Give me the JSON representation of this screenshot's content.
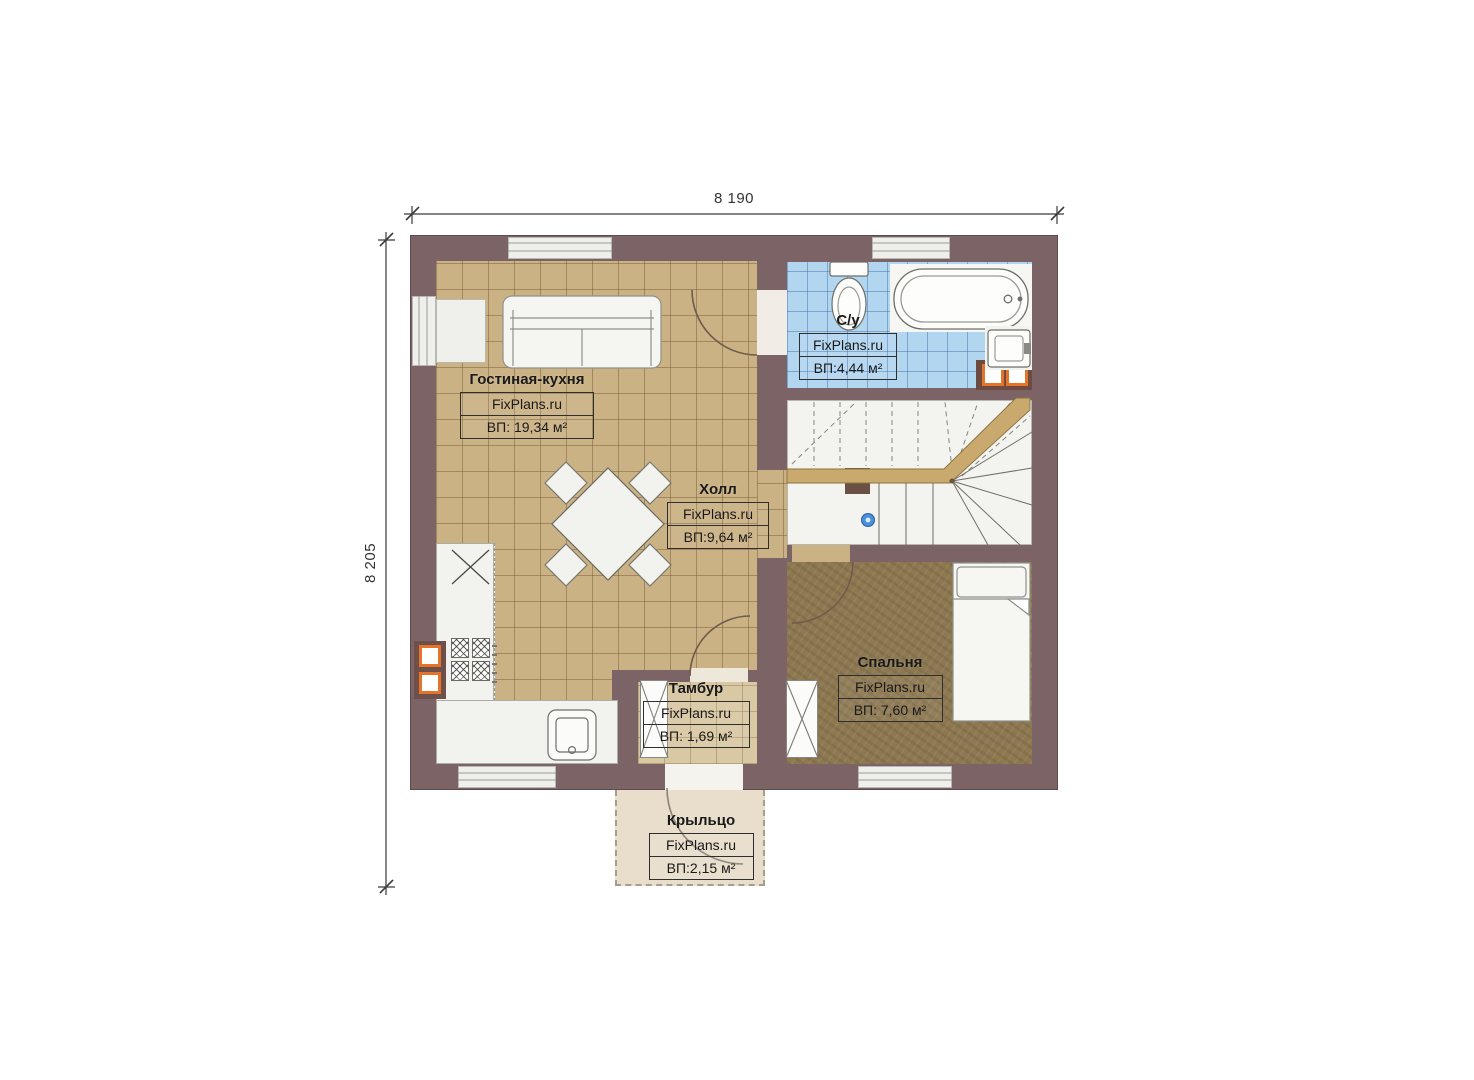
{
  "dimensions": {
    "width_label": "8 190",
    "height_label": "8 205"
  },
  "rooms": {
    "living": {
      "name": "Гостиная-кухня",
      "brand": "FixPlans.ru",
      "area": "ВП: 19,34 м²"
    },
    "bath": {
      "name": "С/у",
      "brand": "FixPlans.ru",
      "area": "ВП:4,44 м²"
    },
    "hall": {
      "name": "Холл",
      "brand": "FixPlans.ru",
      "area": "ВП:9,64 м²"
    },
    "bedroom": {
      "name": "Спальня",
      "brand": "FixPlans.ru",
      "area": "ВП: 7,60 м²"
    },
    "tambour": {
      "name": "Тамбур",
      "brand": "FixPlans.ru",
      "area": "ВП: 1,69 м²"
    },
    "porch": {
      "name": "Крыльцо",
      "brand": "FixPlans.ru",
      "area": "ВП:2,15 м²"
    }
  },
  "colors": {
    "wall": "#7c6466",
    "floor_tile": "#cbb285",
    "bathroom_tile": "#b3d6f0",
    "bedroom_floor": "#8d7850",
    "porch": "#e8decb",
    "stair_rail": "#c9a96d",
    "vent_orange": "#e5732a",
    "marker_blue": "#4a90d9"
  }
}
